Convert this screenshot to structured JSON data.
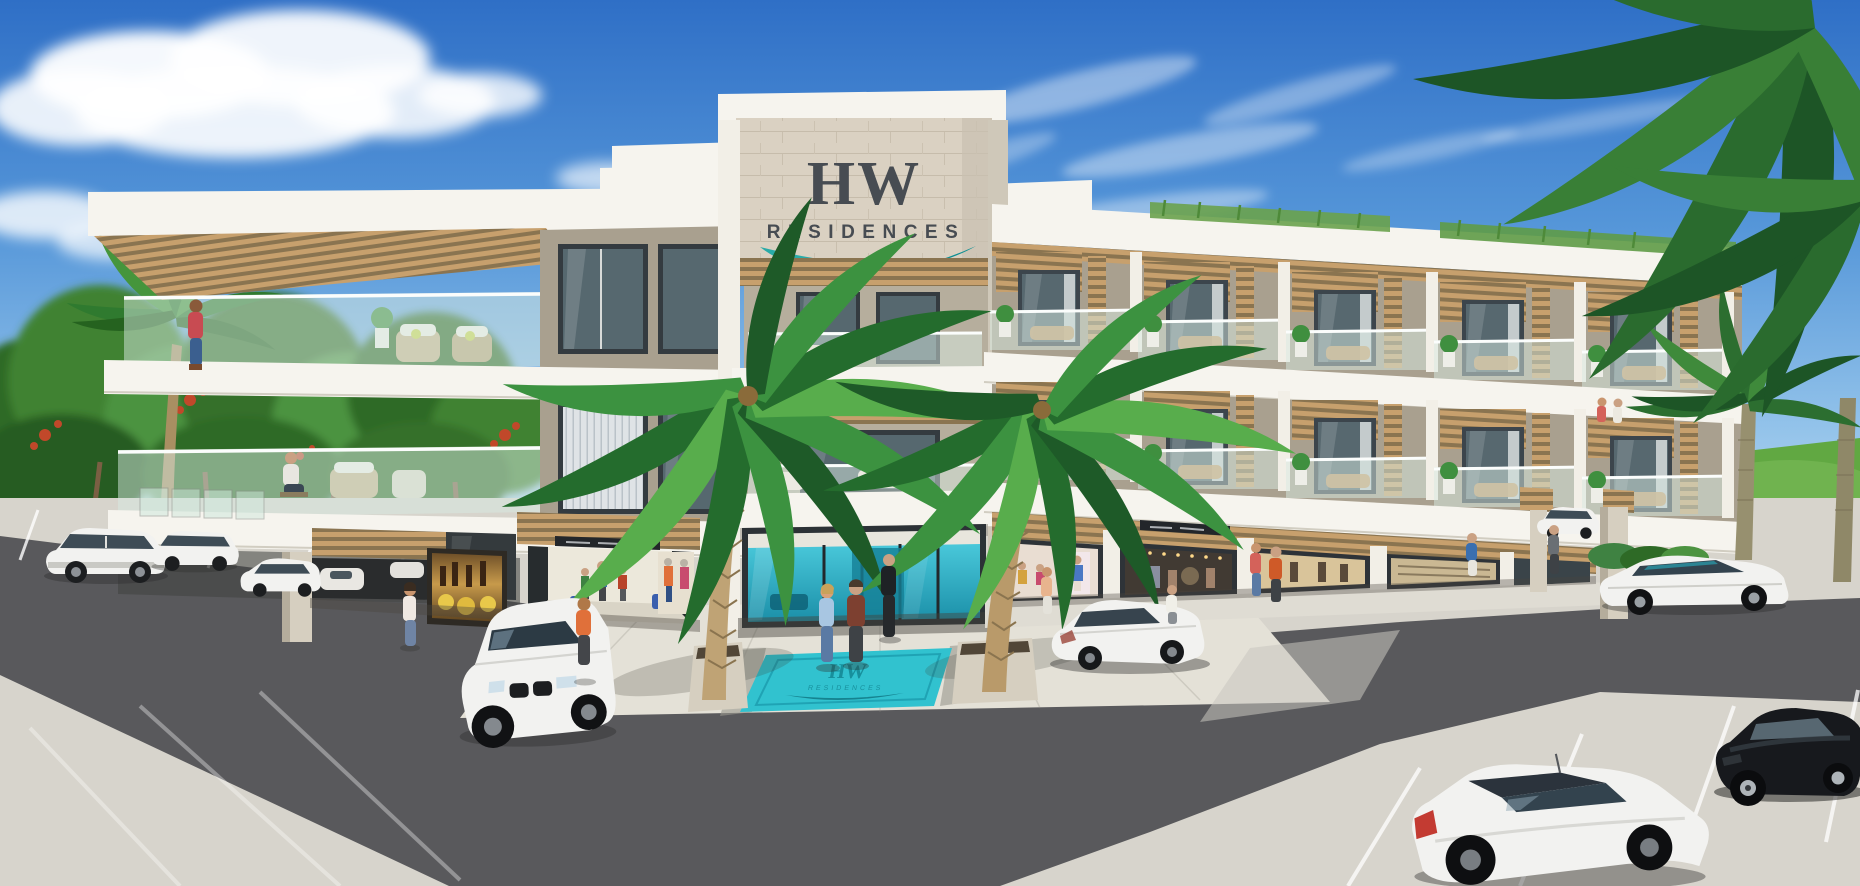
{
  "scene": {
    "title": "HW Residences — exterior architectural rendering",
    "type": "3D rendering",
    "setting": "three-story tropical condominium with rooftop pergolas, glass balconies, ground-floor shops, palm trees and parking lot"
  },
  "logo": {
    "hw": "HW",
    "residences": "RESIDENCES"
  },
  "entrance_mat": {
    "hw": "HW",
    "residences": "RESIDENCES"
  },
  "colors": {
    "sky_top": "#2f6fc6",
    "sky_horizon": "#eaf4fb",
    "brand_teal": "#1aa7a6",
    "brand_teal_dark": "#0e8f93",
    "logo_charcoal": "#474c52",
    "wood_slat": "#c7a06d",
    "wood_gap": "#8a7450",
    "stone": "#dad1c2",
    "wall_greige": "#a9a08f",
    "slab_white": "#f6f4ee",
    "window_glass": "#56686f",
    "balustrade_glass": "#d7eae2",
    "lobby_teal_light": "#49c8da",
    "lobby_teal_dark": "#1b8fa8",
    "mat_teal": "#31c2cf",
    "asphalt": "#59595c",
    "pavement": "#d7d4cc",
    "plaza": "#e4e1d7",
    "lawn": "#61a842",
    "foliage": "#3f8f3f",
    "flower_red": "#c1482a",
    "car_white": "#f2f2f0",
    "car_black": "#17191d"
  },
  "objects": {
    "building": {
      "floors": 3,
      "sections": [
        "left wing terraces",
        "entrance tower with logo sign",
        "right wing balconies"
      ],
      "features": [
        "rooftop grasses",
        "wood slat pergolas",
        "glass balustrades",
        "open carport",
        "wine shop",
        "shopping arcade",
        "teal lobby",
        "retail storefronts"
      ]
    },
    "cars": [
      {
        "id": "suv-parked-left",
        "color": "white"
      },
      {
        "id": "wagon-parked-left",
        "color": "white"
      },
      {
        "id": "sedan-by-column",
        "color": "white"
      },
      {
        "id": "garage-cars",
        "color": "white"
      },
      {
        "id": "suv-front-entrance",
        "color": "white"
      },
      {
        "id": "sedan-center-road",
        "color": "white"
      },
      {
        "id": "suv-right-canopy",
        "color": "white"
      },
      {
        "id": "sedan-right-road",
        "color": "white"
      },
      {
        "id": "sports-car-right",
        "color": "black"
      },
      {
        "id": "coupe-foreground",
        "color": "white"
      }
    ],
    "people": [
      "woman on top-left terrace",
      "man seated on left balcony",
      "couple walking to entrance",
      "man in suit at lobby",
      "woman at wine shop",
      "man in orange at arcade",
      "shoppers on right sidewalk",
      "residents on right balcony",
      "man under right canopy"
    ],
    "vegetation": [
      "two foreground palms flanking entrance",
      "left tree line with red blossoms",
      "rooftop parapet grasses",
      "royal palms at right",
      "palm fronds top-right corner"
    ]
  }
}
